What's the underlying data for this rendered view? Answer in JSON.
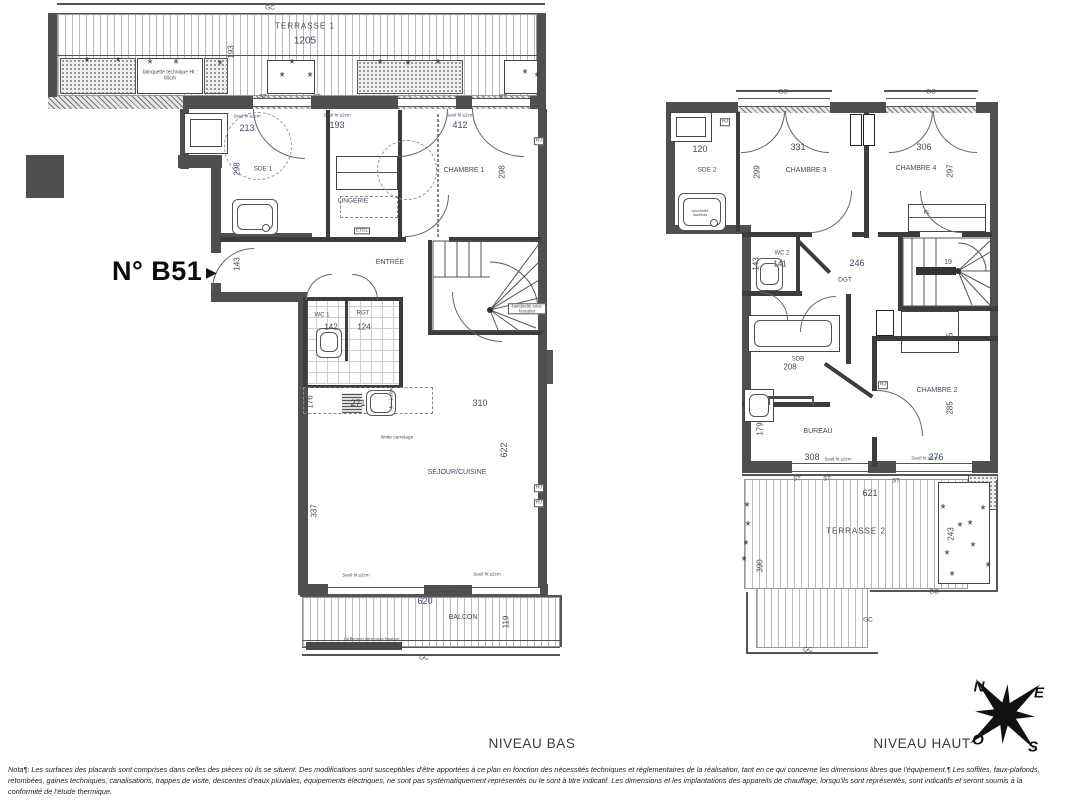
{
  "title": "N° B51",
  "title_arrow": "▶",
  "plant_glyph": "*",
  "captions": {
    "bas": "NIVEAU BAS",
    "haut": "NIVEAU HAUT"
  },
  "compass": {
    "n": "N",
    "e": "E",
    "s": "S",
    "o": "O"
  },
  "palette": {
    "wall": "#4f4f4f",
    "partition": "#3c3c3c",
    "dim_text": "#3f4a5e",
    "paper": "#ffffff"
  },
  "note_lines": [
    "Nota¶: Les surfaces des placards sont comprises dans celles des pièces où ils se situent. Des modifications sont susceptibles d'être apportées à ce plan en fonction des nécessités techniques et réglementaires de la réalisation, tant en ce qui concerne les dimensions libres que l'équipement.¶ Les soffites, faux-plafonds,",
    "retombées, gaines techniques, canalisations, trappes de visite, descentes d'eaux pluviales, équipements électriques, ne sont pas systématiquement représentés ou le sont à titre indicatif. Les dimensions et les implantations des appareils de chauffage, lorsqu'ils sont représentés, sont indicatifs et seront soumis à la",
    "conformité de l'étude thermique."
  ],
  "labels": [
    {
      "n": "gc-label",
      "t": "GC",
      "x": 270,
      "y": 8,
      "s": 6.5
    },
    {
      "n": "room-terrasse-1",
      "t": "TERRASSE 1",
      "x": 305,
      "y": 27,
      "s": 8,
      "ls": 1
    },
    {
      "n": "dim-1205",
      "t": "1205",
      "x": 305,
      "y": 41,
      "s": 10
    },
    {
      "n": "dim-193-v",
      "t": "193",
      "x": 232,
      "y": 52,
      "r": -90,
      "s": 8
    },
    {
      "n": "note-banquette-technique",
      "t": "banquette technique Ht : 60cm",
      "x": 170,
      "y": 76,
      "s": 5,
      "w": 58
    },
    {
      "n": "st-label",
      "t": "ST",
      "x": 263,
      "y": 98,
      "s": 6
    },
    {
      "n": "st-label",
      "t": "ST",
      "x": 317,
      "y": 98,
      "s": 6
    },
    {
      "n": "st-label",
      "t": "ST",
      "x": 503,
      "y": 98,
      "s": 6
    },
    {
      "n": "seuil-note",
      "t": "Seuil ht ≤2cm",
      "x": 247,
      "y": 117,
      "s": 4.5
    },
    {
      "n": "seuil-note",
      "t": "Seuil ht ≤2cm",
      "x": 337,
      "y": 116,
      "s": 4.5
    },
    {
      "n": "seuil-note",
      "t": "Seuil ht ≤2cm",
      "x": 460,
      "y": 116,
      "s": 4.5
    },
    {
      "n": "dim-213",
      "t": "213",
      "x": 247,
      "y": 129,
      "s": 9
    },
    {
      "n": "dim-193",
      "t": "193",
      "x": 337,
      "y": 126,
      "s": 9
    },
    {
      "n": "dim-412",
      "t": "412",
      "x": 460,
      "y": 126,
      "s": 9
    },
    {
      "n": "dim-298-v",
      "t": "298",
      "x": 238,
      "y": 169,
      "r": -90,
      "s": 8
    },
    {
      "n": "room-sde1",
      "t": "SDE 1",
      "x": 263,
      "y": 169,
      "s": 6.5
    },
    {
      "n": "room-lingerie",
      "t": "LINGERIE",
      "x": 353,
      "y": 201,
      "s": 6.5
    },
    {
      "n": "room-chambre1",
      "t": "CHAMBRE 1",
      "x": 464,
      "y": 171,
      "s": 7
    },
    {
      "n": "dim-298b-v",
      "t": "298",
      "x": 503,
      "y": 172,
      "r": -90,
      "s": 8
    },
    {
      "n": "dim-143-v",
      "t": "143",
      "x": 238,
      "y": 264,
      "r": -90,
      "s": 8
    },
    {
      "n": "room-entree",
      "t": "ENTRÉE",
      "x": 390,
      "y": 263,
      "s": 7
    },
    {
      "n": "room-wc1",
      "t": "WC 1",
      "x": 322,
      "y": 316,
      "s": 6
    },
    {
      "n": "dim-142",
      "t": "142",
      "x": 331,
      "y": 328,
      "s": 8
    },
    {
      "n": "room-rgt",
      "t": "RGT",
      "x": 363,
      "y": 314,
      "s": 6
    },
    {
      "n": "dim-124",
      "t": "124",
      "x": 364,
      "y": 328,
      "s": 8
    },
    {
      "n": "dim-176-v",
      "t": "176",
      "x": 311,
      "y": 402,
      "r": -90,
      "s": 8
    },
    {
      "n": "dim-271",
      "t": "271",
      "x": 358,
      "y": 404,
      "s": 9
    },
    {
      "n": "dim-310",
      "t": "310",
      "x": 480,
      "y": 404,
      "s": 9
    },
    {
      "n": "dim-622-v",
      "t": "622",
      "x": 505,
      "y": 450,
      "r": -90,
      "s": 9
    },
    {
      "n": "room-sejour-cuisine",
      "t": "SÉJOUR/CUISINE",
      "x": 457,
      "y": 473,
      "s": 7
    },
    {
      "n": "dim-337-v",
      "t": "337",
      "x": 315,
      "y": 511,
      "r": -90,
      "s": 8
    },
    {
      "n": "note-limite-carrelage",
      "t": "limite carrelage",
      "x": 397,
      "y": 438,
      "s": 4.8
    },
    {
      "n": "note-allege",
      "t": "h = 1.10m",
      "x": 392,
      "y": 398,
      "r": -90,
      "s": 4.5
    },
    {
      "n": "rj-label",
      "t": "RJ",
      "x": 539,
      "y": 141,
      "bx": 1,
      "s": 5
    },
    {
      "n": "rj-label",
      "t": "RJ",
      "x": 539,
      "y": 488,
      "bx": 1,
      "s": 5
    },
    {
      "n": "rj-label",
      "t": "RJ",
      "x": 539,
      "y": 503,
      "bx": 1,
      "s": 5
    },
    {
      "n": "note-banquette-escalier",
      "t": "banquette sous l'escalier",
      "x": 527,
      "y": 309,
      "s": 4.3,
      "bx": 1,
      "w": 34
    },
    {
      "n": "etel-label",
      "t": "ETEL",
      "x": 362,
      "y": 231,
      "bx": 1,
      "s": 4.8
    },
    {
      "n": "seuil-note",
      "t": "Seuil ht ≤2cm",
      "x": 356,
      "y": 576,
      "s": 4.5
    },
    {
      "n": "seuil-note",
      "t": "Seuil ht ≤2cm",
      "x": 487,
      "y": 575,
      "s": 4.5
    },
    {
      "n": "st-label",
      "t": "ST",
      "x": 313,
      "y": 594,
      "s": 6
    },
    {
      "n": "st-label",
      "t": "ST",
      "x": 449,
      "y": 594,
      "s": 6
    },
    {
      "n": "dim-620",
      "t": "620",
      "x": 425,
      "y": 602,
      "s": 9
    },
    {
      "n": "room-balcon",
      "t": "BALCON",
      "x": 463,
      "y": 618,
      "s": 7
    },
    {
      "n": "dim-119-v",
      "t": "119",
      "x": 507,
      "y": 622,
      "r": -90,
      "s": 8
    },
    {
      "n": "note-deflecteur",
      "t": "Déflecteur vitré toute hauteur",
      "x": 372,
      "y": 640,
      "s": 4.3
    },
    {
      "n": "gc-label",
      "t": "GC",
      "x": 424,
      "y": 658,
      "s": 6.5
    },
    {
      "n": "gc-label",
      "t": "GC",
      "x": 783,
      "y": 92,
      "s": 6.5
    },
    {
      "n": "gc-label",
      "t": "GC",
      "x": 931,
      "y": 92,
      "s": 6.5
    },
    {
      "n": "rj-label",
      "t": "RJ",
      "x": 725,
      "y": 122,
      "bx": 1,
      "s": 5
    },
    {
      "n": "dim-120",
      "t": "120",
      "x": 700,
      "y": 150,
      "s": 9
    },
    {
      "n": "dim-331",
      "t": "331",
      "x": 798,
      "y": 148,
      "s": 9
    },
    {
      "n": "dim-306",
      "t": "306",
      "x": 924,
      "y": 148,
      "s": 9
    },
    {
      "n": "room-sde2",
      "t": "SDE 2",
      "x": 707,
      "y": 170,
      "s": 6.5
    },
    {
      "n": "room-chambre3",
      "t": "CHAMBRE 3",
      "x": 806,
      "y": 171,
      "s": 7
    },
    {
      "n": "dim-299-v",
      "t": "299",
      "x": 758,
      "y": 172,
      "r": -90,
      "s": 8
    },
    {
      "n": "room-chambre4",
      "t": "CHAMBRE 4",
      "x": 916,
      "y": 169,
      "s": 7
    },
    {
      "n": "dim-297-v",
      "t": "297",
      "x": 951,
      "y": 171,
      "r": -90,
      "s": 8
    },
    {
      "n": "pl-label",
      "t": "PL",
      "x": 927,
      "y": 213,
      "s": 5.5
    },
    {
      "n": "note-douchette",
      "t": "douchette haut/bas",
      "x": 700,
      "y": 213,
      "s": 3.8,
      "w": 26
    },
    {
      "n": "room-wc2",
      "t": "WC 2",
      "x": 782,
      "y": 254,
      "s": 6
    },
    {
      "n": "dim-141",
      "t": "141",
      "x": 780,
      "y": 265,
      "s": 8
    },
    {
      "n": "dim-143b-v",
      "t": "143",
      "x": 757,
      "y": 264,
      "r": -90,
      "s": 8
    },
    {
      "n": "dim-246",
      "t": "246",
      "x": 857,
      "y": 264,
      "s": 9
    },
    {
      "n": "room-dgt",
      "t": "DGT",
      "x": 845,
      "y": 280,
      "s": 6.5
    },
    {
      "n": "dim-19",
      "t": "19",
      "x": 948,
      "y": 263,
      "s": 7
    },
    {
      "n": "dim-65-v",
      "t": "65",
      "x": 951,
      "y": 337,
      "r": -90,
      "s": 8
    },
    {
      "n": "room-sdb",
      "t": "SDB",
      "x": 798,
      "y": 360,
      "s": 6
    },
    {
      "n": "dim-208",
      "t": "208",
      "x": 790,
      "y": 368,
      "s": 8
    },
    {
      "n": "rj-label",
      "t": "RJ",
      "x": 883,
      "y": 385,
      "bx": 1,
      "s": 5
    },
    {
      "n": "room-bureau",
      "t": "BUREAU",
      "x": 818,
      "y": 432,
      "s": 7
    },
    {
      "n": "dim-179-v",
      "t": "179",
      "x": 761,
      "y": 429,
      "r": -90,
      "s": 8
    },
    {
      "n": "dim-308",
      "t": "308",
      "x": 812,
      "y": 458,
      "s": 9
    },
    {
      "n": "room-chambre2",
      "t": "CHAMBRE 2",
      "x": 937,
      "y": 391,
      "s": 7
    },
    {
      "n": "dim-285-v",
      "t": "285",
      "x": 951,
      "y": 408,
      "r": -90,
      "s": 8
    },
    {
      "n": "dim-276",
      "t": "276",
      "x": 936,
      "y": 458,
      "s": 9
    },
    {
      "n": "seuil-note",
      "t": "Seuil ht ≤2cm",
      "x": 838,
      "y": 460,
      "s": 4.5
    },
    {
      "n": "seuil-note",
      "t": "Seuil ht ≤2cm",
      "x": 925,
      "y": 459,
      "s": 4.5
    },
    {
      "n": "st-label",
      "t": "ST",
      "x": 797,
      "y": 480,
      "s": 6
    },
    {
      "n": "st-label",
      "t": "ST",
      "x": 827,
      "y": 480,
      "s": 6
    },
    {
      "n": "st-label",
      "t": "ST",
      "x": 896,
      "y": 482,
      "s": 6
    },
    {
      "n": "dim-621",
      "t": "621",
      "x": 870,
      "y": 494,
      "s": 9
    },
    {
      "n": "room-terrasse-2",
      "t": "TERRASSE 2",
      "x": 856,
      "y": 532,
      "s": 8,
      "ls": 1
    },
    {
      "n": "dim-243-v",
      "t": "243",
      "x": 952,
      "y": 534,
      "r": -90,
      "s": 8
    },
    {
      "n": "dim-390-v",
      "t": "390",
      "x": 761,
      "y": 566,
      "r": -90,
      "s": 8
    },
    {
      "n": "gc-label",
      "t": "GC",
      "x": 934,
      "y": 592,
      "s": 6.5
    },
    {
      "n": "gc-label",
      "t": "GC",
      "x": 868,
      "y": 620,
      "s": 6.5
    },
    {
      "n": "gc-label",
      "t": "GC",
      "x": 808,
      "y": 650,
      "s": 6.5
    }
  ]
}
